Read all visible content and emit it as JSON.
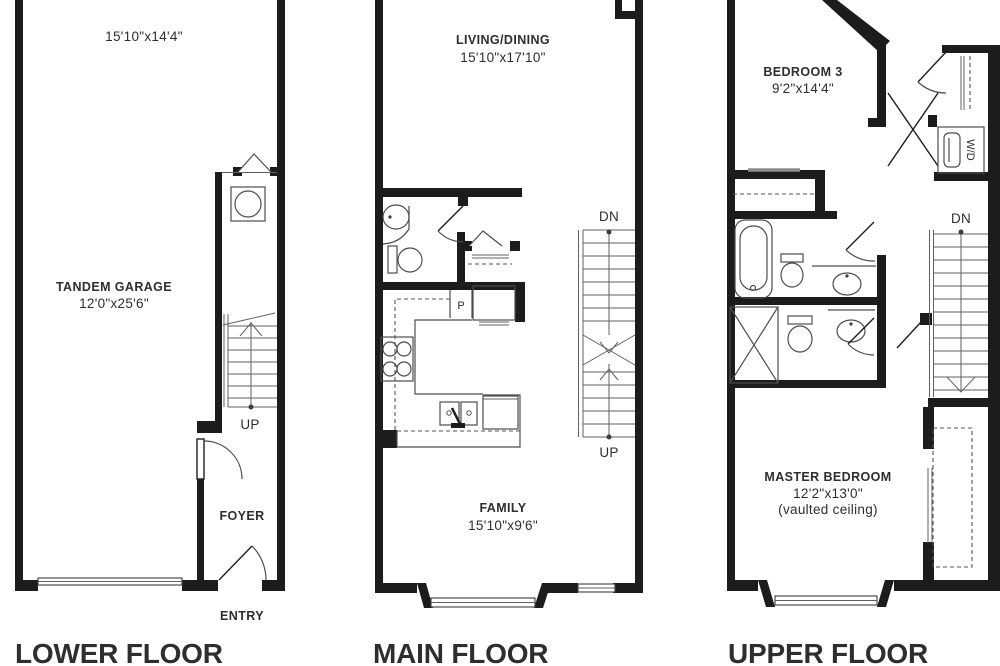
{
  "colors": {
    "wall": "#1c1c1c",
    "line": "#4d4d4d",
    "text": "#2e2e2e"
  },
  "lower": {
    "title": "LOWER FLOOR",
    "room_dims": "15'10\"x14'4\"",
    "garage_name": "TANDEM GARAGE",
    "garage_dims": "12'0\"x25'6\"",
    "foyer_label": "FOYER",
    "entry_label": "ENTRY",
    "stair_label": "UP"
  },
  "main": {
    "title": "MAIN FLOOR",
    "living_name": "LIVING/DINING",
    "living_dims": "15'10\"x17'10\"",
    "family_name": "FAMILY",
    "family_dims": "15'10\"x9'6\"",
    "pantry_label": "P",
    "stair_down_label": "DN",
    "stair_up_label": "UP"
  },
  "upper": {
    "title": "UPPER FLOOR",
    "bedroom3_name": "BEDROOM 3",
    "bedroom3_dims": "9'2\"x14'4\"",
    "master_name": "MASTER BEDROOM",
    "master_dims": "12'2\"x13'0\"",
    "master_note": "(vaulted ceiling)",
    "wd_label": "W/D",
    "stair_down_label": "DN"
  }
}
